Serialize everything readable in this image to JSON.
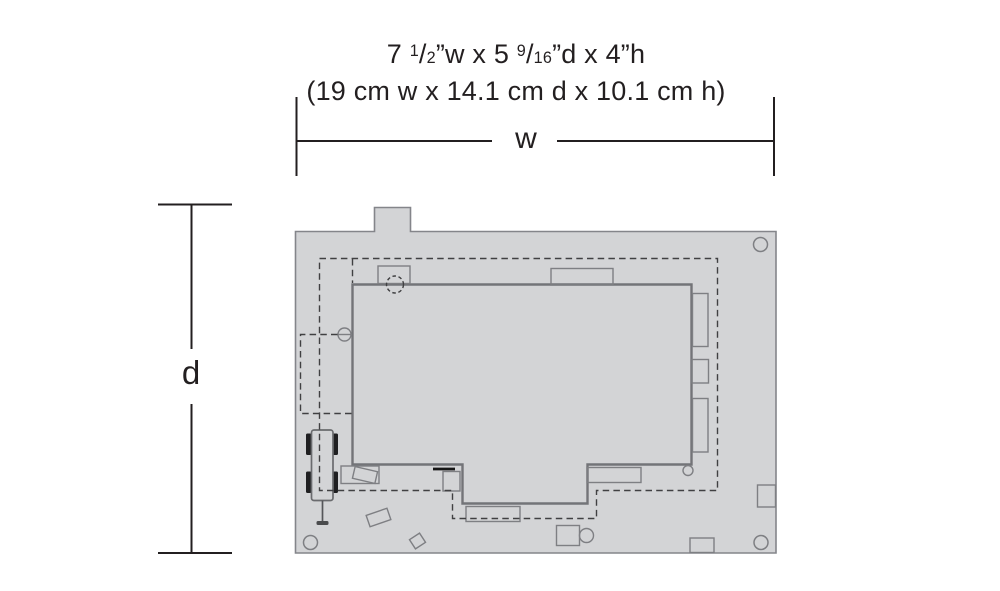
{
  "header": {
    "size_imperial": {
      "pre": "7 ",
      "frac1_num": "1",
      "frac1_slash": "/",
      "frac1_den": "2",
      "mid": "”w x 5 ",
      "frac2_num": "9",
      "frac2_slash": "/",
      "frac2_den": "16",
      "post": "”d x 4”h"
    },
    "size_metric": "(19 cm w x 14.1 cm d x 10.1 cm h)"
  },
  "dimension_labels": {
    "width": "w",
    "depth": "d"
  },
  "colors": {
    "background": "#ffffff",
    "base_fill": "#d3d4d6",
    "plate_outline": "#84858a",
    "building_outline": "#737478",
    "detail_outline": "#7e7f83",
    "dashed_outline": "#404042",
    "dimension_line": "#231f20",
    "text": "#231f20",
    "wheel_fill": "#1f1f21"
  }
}
